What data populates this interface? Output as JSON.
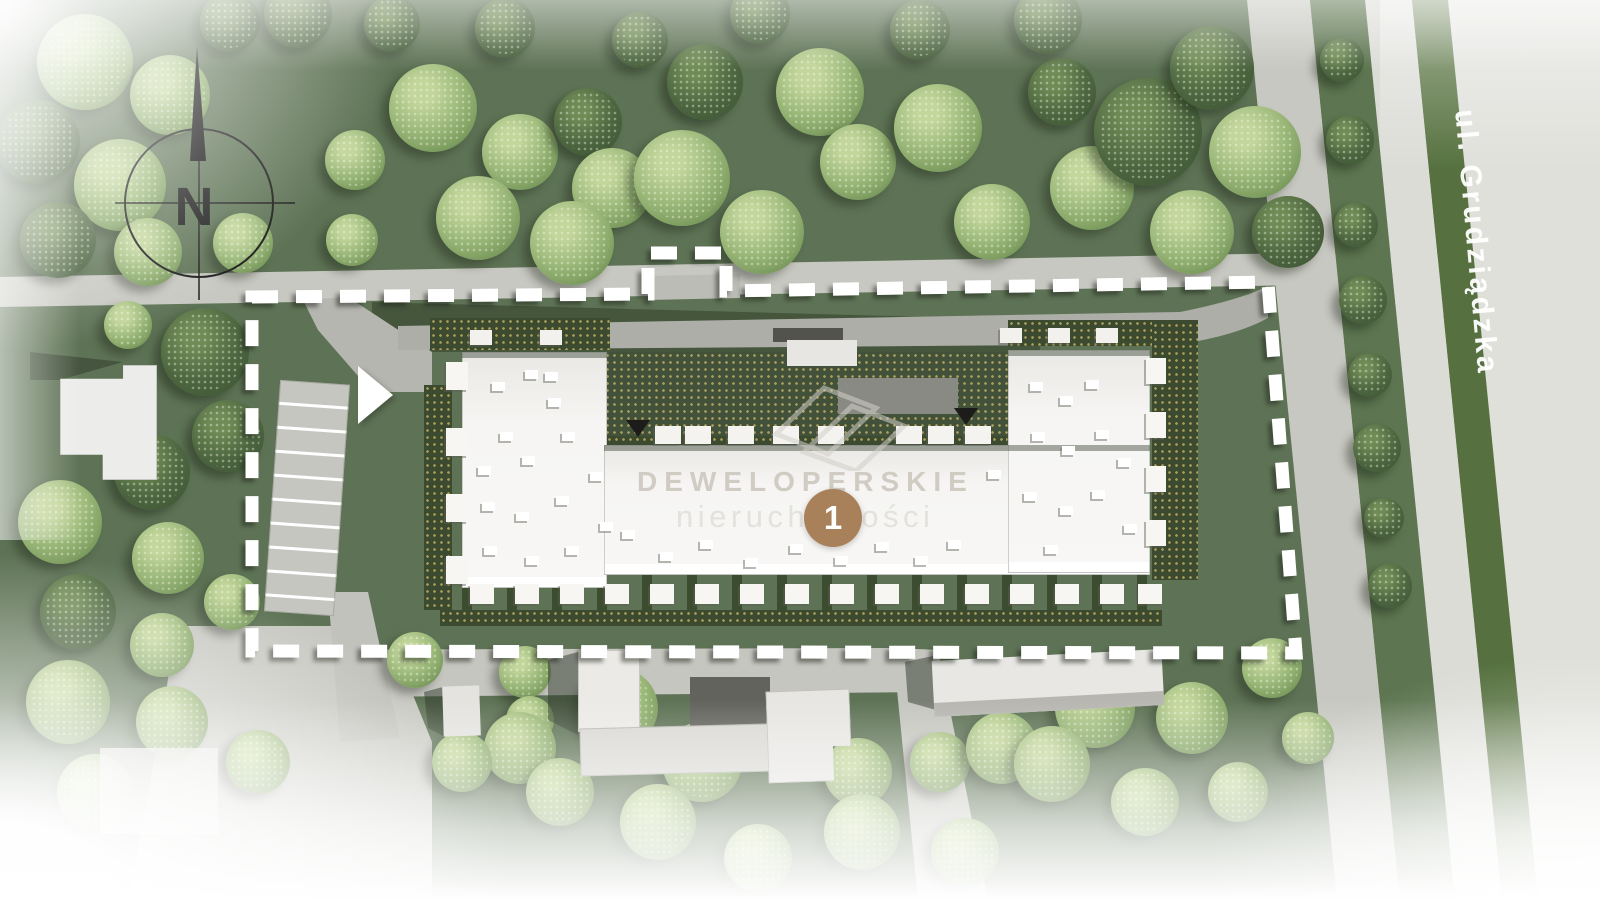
{
  "site_plan": {
    "compass": {
      "label": "N"
    },
    "street": {
      "label": "ul. Grudziądzka"
    },
    "watermark": {
      "brand": "DEWELOPERSKIE",
      "subtitle": "nieruchomości"
    },
    "marker": {
      "label": "1"
    },
    "colors": {
      "grass": "#5e7355",
      "grass_shadow": "#3f4c38",
      "road": "#c8c8c2",
      "driveway": "#aeaea8",
      "street_surface": "#dcdcd7",
      "median_green": "#56713f",
      "hedge": "#3c4b2f",
      "hedge_dot": "#cdb76a",
      "building_roof": "#f5f4f2",
      "marker_bg": "#a8815a",
      "boundary_dash": "#ffffff",
      "tree_light": "#9cb97a",
      "tree_dark": "#4d6640",
      "watermark_text": "#cfccc4"
    },
    "vegetation": [
      [
        85,
        62,
        48,
        "l"
      ],
      [
        170,
        95,
        40,
        "l"
      ],
      [
        38,
        142,
        42,
        "d"
      ],
      [
        120,
        185,
        46,
        "l"
      ],
      [
        58,
        240,
        38,
        "d"
      ],
      [
        148,
        252,
        34,
        "l"
      ],
      [
        243,
        243,
        30,
        "l"
      ],
      [
        230,
        22,
        30,
        "d"
      ],
      [
        298,
        14,
        34,
        "d"
      ],
      [
        128,
        325,
        24,
        "l"
      ],
      [
        205,
        352,
        44,
        "d"
      ],
      [
        228,
        436,
        36,
        "d"
      ],
      [
        433,
        108,
        44,
        "l"
      ],
      [
        520,
        152,
        38,
        "l"
      ],
      [
        478,
        218,
        42,
        "l"
      ],
      [
        588,
        122,
        34,
        "d"
      ],
      [
        612,
        188,
        40,
        "l"
      ],
      [
        572,
        243,
        42,
        "l"
      ],
      [
        682,
        178,
        48,
        "l"
      ],
      [
        705,
        82,
        38,
        "d"
      ],
      [
        762,
        232,
        42,
        "l"
      ],
      [
        820,
        92,
        44,
        "l"
      ],
      [
        858,
        162,
        38,
        "l"
      ],
      [
        938,
        128,
        44,
        "l"
      ],
      [
        992,
        222,
        38,
        "l"
      ],
      [
        1062,
        92,
        34,
        "d"
      ],
      [
        1092,
        188,
        42,
        "l"
      ],
      [
        1148,
        132,
        54,
        "d"
      ],
      [
        1212,
        68,
        42,
        "d"
      ],
      [
        1255,
        152,
        46,
        "l"
      ],
      [
        1288,
        232,
        36,
        "d"
      ],
      [
        1192,
        232,
        42,
        "l"
      ],
      [
        1048,
        20,
        34,
        "d"
      ],
      [
        920,
        30,
        30,
        "d"
      ],
      [
        760,
        14,
        30,
        "d"
      ],
      [
        640,
        40,
        28,
        "d"
      ],
      [
        505,
        28,
        30,
        "d"
      ],
      [
        392,
        24,
        28,
        "d"
      ],
      [
        355,
        160,
        30,
        "l"
      ],
      [
        352,
        240,
        26,
        "l"
      ],
      [
        152,
        472,
        38,
        "d"
      ],
      [
        60,
        522,
        42,
        "l"
      ],
      [
        168,
        558,
        36,
        "l"
      ],
      [
        78,
        612,
        38,
        "d"
      ],
      [
        162,
        645,
        32,
        "l"
      ],
      [
        232,
        602,
        28,
        "l"
      ],
      [
        68,
        702,
        42,
        "l"
      ],
      [
        172,
        722,
        36,
        "l"
      ],
      [
        258,
        762,
        32,
        "l"
      ],
      [
        95,
        792,
        38,
        "l"
      ],
      [
        415,
        660,
        28,
        "l"
      ],
      [
        525,
        672,
        26,
        "l"
      ],
      [
        530,
        720,
        24,
        "l"
      ],
      [
        520,
        748,
        36,
        "l"
      ],
      [
        618,
        708,
        40,
        "l"
      ],
      [
        702,
        762,
        40,
        "l"
      ],
      [
        790,
        728,
        30,
        "l"
      ],
      [
        858,
        772,
        34,
        "l"
      ],
      [
        940,
        762,
        30,
        "l"
      ],
      [
        1002,
        748,
        36,
        "l"
      ],
      [
        1095,
        708,
        40,
        "l"
      ],
      [
        1192,
        718,
        36,
        "l"
      ],
      [
        1272,
        668,
        30,
        "l"
      ],
      [
        1308,
        738,
        26,
        "l"
      ],
      [
        1052,
        764,
        38,
        "l"
      ],
      [
        1145,
        802,
        34,
        "l"
      ],
      [
        1238,
        792,
        30,
        "l"
      ],
      [
        965,
        852,
        34,
        "l"
      ],
      [
        862,
        832,
        38,
        "l"
      ],
      [
        758,
        858,
        34,
        "l"
      ],
      [
        658,
        822,
        38,
        "l"
      ],
      [
        560,
        792,
        34,
        "l"
      ],
      [
        462,
        762,
        30,
        "l"
      ],
      [
        1342,
        60,
        22,
        "d"
      ],
      [
        1350,
        140,
        24,
        "d"
      ],
      [
        1356,
        225,
        22,
        "d"
      ],
      [
        1363,
        300,
        24,
        "d"
      ],
      [
        1370,
        375,
        22,
        "d"
      ],
      [
        1377,
        448,
        24,
        "d"
      ],
      [
        1384,
        518,
        20,
        "d"
      ],
      [
        1390,
        586,
        22,
        "d"
      ]
    ],
    "building": {
      "roof_vents": [
        [
          492,
          382
        ],
        [
          525,
          370
        ],
        [
          548,
          398
        ],
        [
          500,
          432
        ],
        [
          478,
          466
        ],
        [
          522,
          456
        ],
        [
          562,
          432
        ],
        [
          482,
          502
        ],
        [
          516,
          512
        ],
        [
          556,
          496
        ],
        [
          590,
          472
        ],
        [
          484,
          546
        ],
        [
          526,
          556
        ],
        [
          566,
          546
        ],
        [
          600,
          522
        ],
        [
          545,
          372
        ],
        [
          622,
          530
        ],
        [
          660,
          552
        ],
        [
          700,
          540
        ],
        [
          745,
          558
        ],
        [
          790,
          544
        ],
        [
          835,
          556
        ],
        [
          876,
          542
        ],
        [
          915,
          556
        ],
        [
          948,
          540
        ],
        [
          1030,
          382
        ],
        [
          1060,
          396
        ],
        [
          1086,
          380
        ],
        [
          1032,
          432
        ],
        [
          1062,
          446
        ],
        [
          1096,
          430
        ],
        [
          1024,
          492
        ],
        [
          1060,
          506
        ],
        [
          1092,
          490
        ],
        [
          1118,
          458
        ],
        [
          1124,
          524
        ],
        [
          1045,
          545
        ],
        [
          988,
          470
        ]
      ],
      "balconies_x": [
        655,
        685,
        728,
        773,
        818,
        896,
        928,
        965
      ],
      "terraces_south_x": [
        470,
        515,
        560,
        605,
        650,
        695,
        740,
        785,
        830,
        875,
        920,
        965,
        1010,
        1055,
        1100,
        1138
      ],
      "terraces_west_y": [
        362,
        428,
        494,
        556
      ],
      "terraces_east_y": [
        358,
        412,
        466,
        520
      ],
      "north_boxes": [
        [
          470,
          330
        ],
        [
          540,
          330
        ],
        [
          1000,
          328
        ],
        [
          1048,
          328
        ],
        [
          1096,
          328
        ]
      ]
    }
  }
}
